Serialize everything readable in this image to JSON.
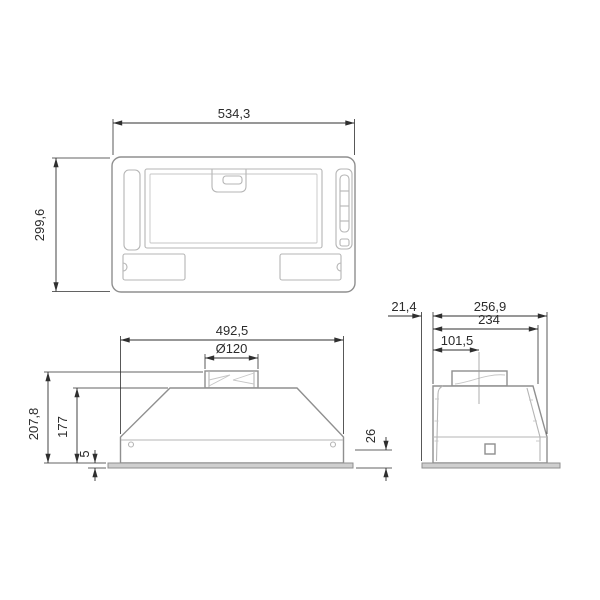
{
  "drawing": {
    "kind": "technical-dimension-drawing",
    "views": {
      "top": {
        "width": "534,3",
        "depth": "299,6"
      },
      "front": {
        "width": "492,5",
        "duct_diameter": "Ø120",
        "height_total": "207,8",
        "height_body": "177",
        "flange_height": "5",
        "base_band_height": "26"
      },
      "side": {
        "flange_overhang": "21,4",
        "depth_total": "256,9",
        "depth_top": "234",
        "duct_center_offset": "101,5"
      }
    },
    "colors": {
      "outline": "#8f8f8f",
      "detail": "#b5b5b5",
      "dimension": "#2f2f2f",
      "flange_fill": "#cfcfcf",
      "background": "#ffffff"
    }
  }
}
